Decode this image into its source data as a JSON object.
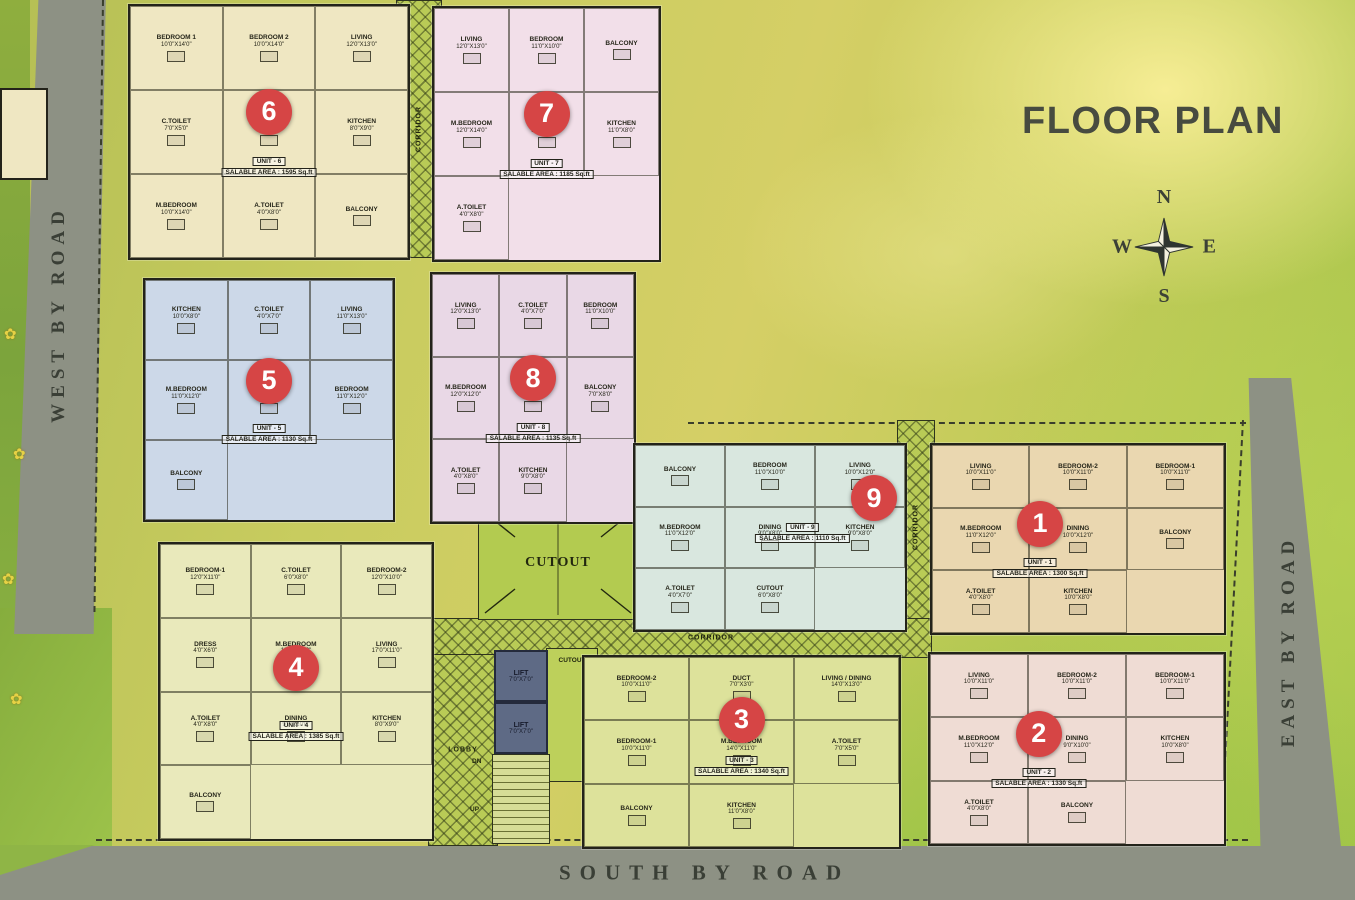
{
  "title": "FLOOR PLAN",
  "compass": {
    "north": "N",
    "south": "S",
    "east": "E",
    "west": "W"
  },
  "roads": {
    "west": "WEST BY ROAD",
    "east": "EAST BY ROAD",
    "south": "SOUTH BY ROAD"
  },
  "areas": {
    "corridor": "CORRIDOR",
    "cutout": "CUTOUT",
    "lobby": "LOBBY",
    "lift": "LIFT",
    "lift_dims": "7'0\"X7'0\"",
    "stairs_down": "DN",
    "stairs_up": "UP"
  },
  "badge_color": "#d64545",
  "units": [
    {
      "number": "1",
      "unit_label": "UNIT - 1",
      "area_label": "SALABLE AREA : 1300 Sq.ft",
      "color": "#ead7b0",
      "rooms": [
        {
          "name": "LIVING",
          "dims": "10'0\"X11'0\""
        },
        {
          "name": "BEDROOM-2",
          "dims": "10'0\"X11'0\""
        },
        {
          "name": "BEDROOM-1",
          "dims": "10'0\"X11'0\""
        },
        {
          "name": "M.BEDROOM",
          "dims": "11'0\"X12'0\""
        },
        {
          "name": "DINING",
          "dims": "10'0\"X12'0\""
        },
        {
          "name": "BALCONY",
          "dims": ""
        },
        {
          "name": "A.TOILET",
          "dims": "4'0\"X8'0\""
        },
        {
          "name": "KITCHEN",
          "dims": "10'0\"X8'0\""
        }
      ]
    },
    {
      "number": "2",
      "unit_label": "UNIT - 2",
      "area_label": "SALABLE AREA : 1330 Sq.ft",
      "color": "#efdcd4",
      "rooms": [
        {
          "name": "LIVING",
          "dims": "10'0\"X11'0\""
        },
        {
          "name": "BEDROOM-2",
          "dims": "10'0\"X11'0\""
        },
        {
          "name": "BEDROOM-1",
          "dims": "10'0\"X11'0\""
        },
        {
          "name": "M.BEDROOM",
          "dims": "11'0\"X12'0\""
        },
        {
          "name": "DINING",
          "dims": "9'0\"X10'0\""
        },
        {
          "name": "KITCHEN",
          "dims": "10'0\"X8'0\""
        },
        {
          "name": "A.TOILET",
          "dims": "4'0\"X8'0\""
        },
        {
          "name": "BALCONY",
          "dims": ""
        }
      ]
    },
    {
      "number": "3",
      "unit_label": "UNIT - 3",
      "area_label": "SALABLE AREA : 1340 Sq.ft",
      "color": "#dde29b",
      "rooms": [
        {
          "name": "BEDROOM-2",
          "dims": "10'0\"X11'0\""
        },
        {
          "name": "DUCT",
          "dims": "7'0\"X3'0\""
        },
        {
          "name": "LIVING / DINING",
          "dims": "14'0\"X13'0\""
        },
        {
          "name": "BEDROOM-1",
          "dims": "10'0\"X11'0\""
        },
        {
          "name": "M.BEDROOM",
          "dims": "14'0\"X11'0\""
        },
        {
          "name": "A.TOILET",
          "dims": "7'0\"X5'0\""
        },
        {
          "name": "BALCONY",
          "dims": ""
        },
        {
          "name": "KITCHEN",
          "dims": "11'0\"X8'0\""
        }
      ]
    },
    {
      "number": "4",
      "unit_label": "UNIT - 4",
      "area_label": "SALABLE AREA : 1385 Sq.ft",
      "color": "#e9e9bb",
      "rooms": [
        {
          "name": "BEDROOM-1",
          "dims": "12'0\"X11'0\""
        },
        {
          "name": "C.TOILET",
          "dims": "6'0\"X8'0\""
        },
        {
          "name": "BEDROOM-2",
          "dims": "12'0\"X10'0\""
        },
        {
          "name": "DRESS",
          "dims": "4'0\"X6'0\""
        },
        {
          "name": "M.BEDROOM",
          "dims": "12'0\"X12'0\""
        },
        {
          "name": "LIVING",
          "dims": "17'0\"X11'0\""
        },
        {
          "name": "A.TOILET",
          "dims": "4'0\"X8'0\""
        },
        {
          "name": "DINING",
          "dims": "9'0\"X10'0\""
        },
        {
          "name": "KITCHEN",
          "dims": "8'0\"X9'0\""
        },
        {
          "name": "BALCONY",
          "dims": ""
        }
      ]
    },
    {
      "number": "5",
      "unit_label": "UNIT - 5",
      "area_label": "SALABLE AREA : 1130 Sq.ft",
      "color": "#ccd8e8",
      "rooms": [
        {
          "name": "KITCHEN",
          "dims": "10'0\"X8'0\""
        },
        {
          "name": "C.TOILET",
          "dims": "4'0\"X7'0\""
        },
        {
          "name": "LIVING",
          "dims": "11'0\"X13'0\""
        },
        {
          "name": "M.BEDROOM",
          "dims": "11'0\"X12'0\""
        },
        {
          "name": "DINING",
          "dims": "12'0\"X8'0\""
        },
        {
          "name": "BEDROOM",
          "dims": "11'0\"X12'0\""
        },
        {
          "name": "BALCONY",
          "dims": ""
        }
      ]
    },
    {
      "number": "6",
      "unit_label": "UNIT - 6",
      "area_label": "SALABLE AREA : 1595 Sq.ft",
      "color": "#efe7c2",
      "rooms": [
        {
          "name": "BEDROOM 1",
          "dims": "10'0\"X14'0\""
        },
        {
          "name": "BEDROOM 2",
          "dims": "10'0\"X14'0\""
        },
        {
          "name": "LIVING",
          "dims": "12'0\"X13'0\""
        },
        {
          "name": "C.TOILET",
          "dims": "7'0\"X5'0\""
        },
        {
          "name": "DINING",
          "dims": "9'0\"X13'0\""
        },
        {
          "name": "KITCHEN",
          "dims": "8'0\"X9'0\""
        },
        {
          "name": "M.BEDROOM",
          "dims": "10'0\"X14'0\""
        },
        {
          "name": "A.TOILET",
          "dims": "4'0\"X8'0\""
        },
        {
          "name": "BALCONY",
          "dims": ""
        }
      ]
    },
    {
      "number": "7",
      "unit_label": "UNIT - 7",
      "area_label": "SALABLE AREA : 1185 Sq.ft",
      "color": "#f2dfe9",
      "rooms": [
        {
          "name": "LIVING",
          "dims": "12'0\"X13'0\""
        },
        {
          "name": "BEDROOM",
          "dims": "11'0\"X10'0\""
        },
        {
          "name": "BALCONY",
          "dims": ""
        },
        {
          "name": "M.BEDROOM",
          "dims": "12'0\"X14'0\""
        },
        {
          "name": "DINING",
          "dims": "12'0\"X10'0\""
        },
        {
          "name": "KITCHEN",
          "dims": "11'0\"X8'0\""
        },
        {
          "name": "A.TOILET",
          "dims": "4'0\"X8'0\""
        }
      ]
    },
    {
      "number": "8",
      "unit_label": "UNIT - 8",
      "area_label": "SALABLE AREA : 1135 Sq.ft",
      "color": "#e9d8e6",
      "rooms": [
        {
          "name": "LIVING",
          "dims": "12'0\"X13'0\""
        },
        {
          "name": "C.TOILET",
          "dims": "4'0\"X7'0\""
        },
        {
          "name": "BEDROOM",
          "dims": "11'0\"X10'0\""
        },
        {
          "name": "M.BEDROOM",
          "dims": "12'0\"X12'0\""
        },
        {
          "name": "DINING",
          "dims": "10'0\"X8'0\""
        },
        {
          "name": "BALCONY",
          "dims": "7'0\"X8'0\""
        },
        {
          "name": "A.TOILET",
          "dims": "4'0\"X8'0\""
        },
        {
          "name": "KITCHEN",
          "dims": "9'0\"X8'0\""
        }
      ]
    },
    {
      "number": "9",
      "unit_label": "UNIT - 9",
      "area_label": "SALABLE AREA : 1110 Sq.ft",
      "color": "#d9e7df",
      "rooms": [
        {
          "name": "BALCONY",
          "dims": ""
        },
        {
          "name": "BEDROOM",
          "dims": "11'0\"X10'0\""
        },
        {
          "name": "LIVING",
          "dims": "10'0\"X12'0\""
        },
        {
          "name": "M.BEDROOM",
          "dims": "11'0\"X12'0\""
        },
        {
          "name": "DINING",
          "dims": "9'0\"X8'0\""
        },
        {
          "name": "KITCHEN",
          "dims": "9'0\"X8'0\""
        },
        {
          "name": "A.TOILET",
          "dims": "4'0\"X7'0\""
        },
        {
          "name": "CUTOUT",
          "dims": "6'0\"X8'0\""
        }
      ]
    }
  ]
}
